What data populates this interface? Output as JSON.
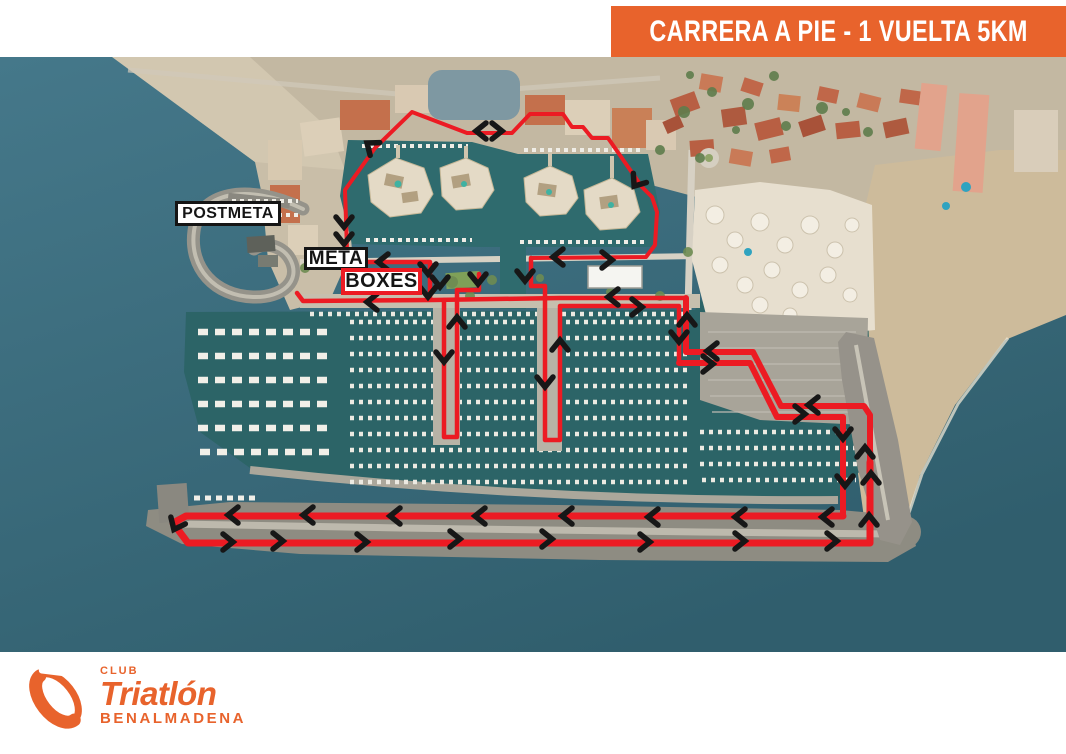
{
  "header": {
    "title": "CARRERA A PIE - 1 VUELTA 5KM"
  },
  "colors": {
    "accent_orange": "#E8632C",
    "route_red": "#EC1B23",
    "arrow_black": "#171717",
    "sea": "#41758A",
    "marina_water": "#2C6467"
  },
  "map_labels": [
    {
      "id": "postmeta",
      "text": "POSTMETA",
      "x": 175,
      "y": 201,
      "w": 106,
      "h": 25,
      "font_size": 16,
      "border": "#151515"
    },
    {
      "id": "meta",
      "text": "META",
      "x": 304,
      "y": 247,
      "w": 64,
      "h": 23,
      "font_size": 19,
      "border": "#151515"
    },
    {
      "id": "boxes",
      "text": "BOXES",
      "x": 341,
      "y": 268,
      "w": 81,
      "h": 27,
      "font_size": 20,
      "border": "#EC1B23"
    }
  ],
  "route": {
    "polylines": [
      {
        "id": "loop-north",
        "width": 4,
        "points": [
          [
            347,
            250
          ],
          [
            345,
            190
          ],
          [
            375,
            148
          ],
          [
            412,
            112
          ],
          [
            467,
            133
          ],
          [
            512,
            133
          ],
          [
            530,
            114
          ],
          [
            563,
            114
          ],
          [
            572,
            127
          ],
          [
            583,
            127
          ],
          [
            592,
            138
          ],
          [
            608,
            138
          ],
          [
            642,
            187
          ],
          [
            652,
            197
          ],
          [
            657,
            212
          ],
          [
            655,
            245
          ],
          [
            646,
            257
          ],
          [
            531,
            258
          ]
        ]
      },
      {
        "id": "central-out",
        "width": 4.5,
        "points": [
          [
            531,
            258
          ],
          [
            531,
            286
          ],
          [
            545,
            286
          ],
          [
            545,
            440
          ],
          [
            560,
            440
          ],
          [
            560,
            306
          ],
          [
            679,
            306
          ],
          [
            679,
            363
          ]
        ]
      },
      {
        "id": "east-out",
        "width": 6,
        "points": [
          [
            679,
            363
          ],
          [
            750,
            363
          ],
          [
            777,
            417
          ],
          [
            843,
            417
          ],
          [
            843,
            516
          ]
        ]
      },
      {
        "id": "breakwater-loop",
        "width": 7,
        "points": [
          [
            843,
            516
          ],
          [
            186,
            516
          ],
          [
            173,
            523
          ],
          [
            188,
            543
          ],
          [
            870,
            543
          ],
          [
            870,
            462
          ]
        ]
      },
      {
        "id": "east-return",
        "width": 6,
        "points": [
          [
            870,
            462
          ],
          [
            870,
            415
          ],
          [
            864,
            406
          ],
          [
            781,
            406
          ],
          [
            753,
            352
          ],
          [
            686,
            352
          ],
          [
            686,
            298
          ]
        ]
      },
      {
        "id": "quay-return",
        "width": 4.5,
        "points": [
          [
            686,
            298
          ],
          [
            560,
            298
          ],
          [
            433,
            300
          ],
          [
            303,
            301
          ],
          [
            297,
            293
          ]
        ]
      },
      {
        "id": "pier-a-outback",
        "width": 4.5,
        "points": [
          [
            444,
            300
          ],
          [
            444,
            437
          ],
          [
            457,
            437
          ],
          [
            457,
            290
          ],
          [
            479,
            290
          ],
          [
            479,
            274
          ]
        ]
      },
      {
        "id": "finish-straight",
        "width": 4.5,
        "points": [
          [
            359,
            262
          ],
          [
            430,
            262
          ],
          [
            430,
            298
          ]
        ]
      }
    ],
    "arrows": [
      [
        481,
        131,
        180
      ],
      [
        497,
        131,
        0
      ],
      [
        371,
        146,
        217
      ],
      [
        344,
        222,
        90
      ],
      [
        344,
        239,
        90
      ],
      [
        637,
        182,
        125
      ],
      [
        558,
        257,
        180
      ],
      [
        607,
        260,
        0
      ],
      [
        525,
        276,
        90
      ],
      [
        383,
        262,
        180
      ],
      [
        428,
        269,
        90
      ],
      [
        428,
        292,
        90
      ],
      [
        372,
        302,
        180
      ],
      [
        440,
        282,
        90
      ],
      [
        478,
        279,
        90
      ],
      [
        444,
        357,
        90
      ],
      [
        457,
        322,
        270
      ],
      [
        545,
        382,
        90
      ],
      [
        560,
        345,
        270
      ],
      [
        613,
        297,
        180
      ],
      [
        637,
        307,
        0
      ],
      [
        679,
        337,
        90
      ],
      [
        687,
        320,
        270
      ],
      [
        712,
        351,
        180
      ],
      [
        708,
        364,
        0
      ],
      [
        813,
        405,
        180
      ],
      [
        800,
        414,
        0
      ],
      [
        843,
        434,
        90
      ],
      [
        845,
        481,
        90
      ],
      [
        865,
        452,
        270
      ],
      [
        871,
        478,
        270
      ],
      [
        869,
        520,
        270
      ],
      [
        233,
        515,
        180
      ],
      [
        308,
        515,
        180
      ],
      [
        395,
        516,
        180
      ],
      [
        480,
        516,
        180
      ],
      [
        567,
        516,
        180
      ],
      [
        653,
        517,
        180
      ],
      [
        740,
        517,
        180
      ],
      [
        827,
        517,
        180
      ],
      [
        176,
        525,
        115
      ],
      [
        228,
        542,
        0
      ],
      [
        278,
        541,
        0
      ],
      [
        362,
        542,
        0
      ],
      [
        455,
        539,
        0
      ],
      [
        547,
        539,
        0
      ],
      [
        645,
        542,
        0
      ],
      [
        740,
        541,
        0
      ],
      [
        832,
        541,
        0
      ]
    ]
  },
  "logo": {
    "club": "CLUB",
    "name": "Triatlón",
    "city": "BENALMADENA"
  }
}
